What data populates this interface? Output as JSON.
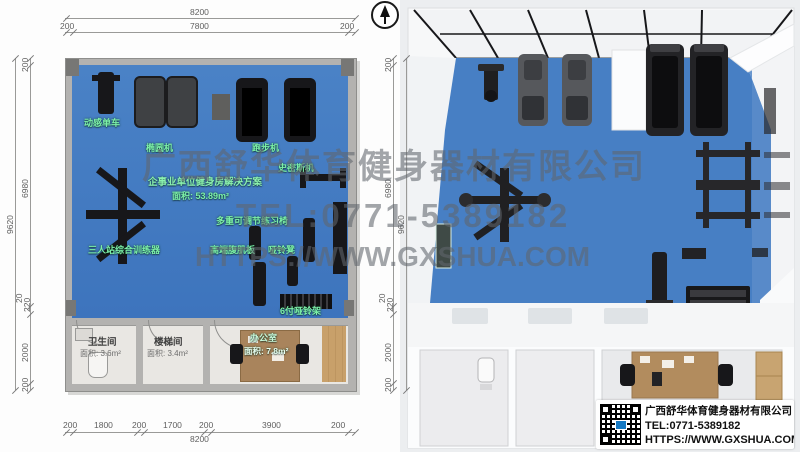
{
  "watermark": {
    "company": "广西舒华体育健身器材有限公司",
    "tel": "TEL:0771-5389182",
    "url": "HTTPS://WWW.GXSHUA.COM"
  },
  "plan": {
    "title": "企事业单位健身房解决方案",
    "area": "面积: 53.89m²",
    "labels": {
      "spin_bike": "动感单车",
      "elliptical": "椭圆机",
      "treadmill": "跑步机",
      "smith": "史密斯机",
      "adj_bench": "多重可调节练习椅",
      "station3": "三人站综合训练器",
      "ab_board": "高端腹肌板",
      "db_bench": "哑铃凳",
      "db_rack": "6付哑铃架"
    },
    "rooms": {
      "toilet_name": "卫生间",
      "toilet_area": "面积: 3.6m²",
      "stairs_name": "楼梯间",
      "stairs_area": "面积: 3.4m²",
      "office_name": "办公室",
      "office_area": "面积: 7.8m²"
    },
    "dims": {
      "top_total": "8200",
      "top_left": "200",
      "top_mid": "7800",
      "top_right": "200",
      "left_total": "9620",
      "v1": "200",
      "v2": "6980",
      "v3": "220",
      "v4": "20",
      "v5": "2000",
      "v6": "200",
      "b1": "200",
      "b2": "1800",
      "b3": "200",
      "b4": "1700",
      "b5": "200",
      "b6": "3900",
      "b7": "200",
      "bottom_total": "8200"
    }
  },
  "logo": {
    "company": "广西舒华体育健身器材有限公司",
    "tel": "TEL:0771-5389182",
    "url": "HTTPS://WWW.GXSHUA.COM"
  },
  "colors": {
    "floor_blue": "#4a82c6",
    "wall_gray": "#b3b2b0",
    "label_green": "#7df0a8",
    "equipment_black": "#17171a",
    "wood": "#c8a06a"
  }
}
